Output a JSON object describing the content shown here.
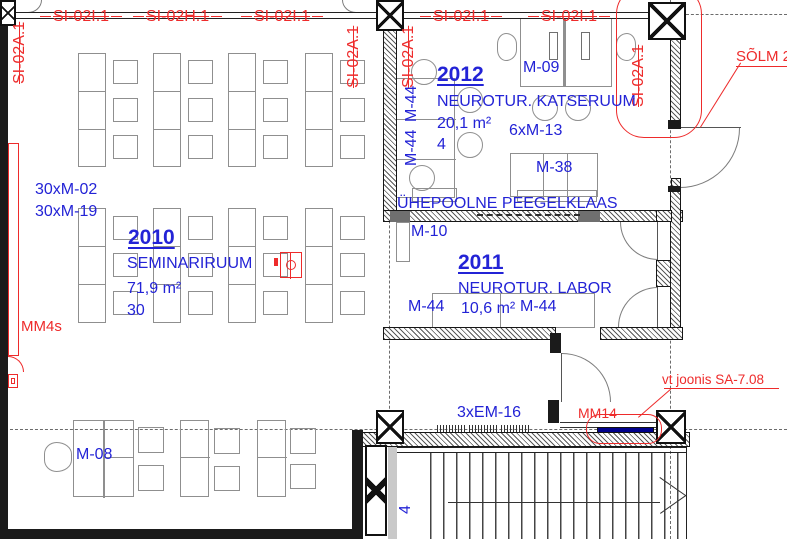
{
  "title": "floor-plan-detail",
  "colors": {
    "text_blue": "#2323d6",
    "annotation_red": "#ee2b2b",
    "wall_black": "#1b1b1b",
    "furniture_gray": "#8f8f8f",
    "mm14_bar_blue": "#00008b"
  },
  "top_grid_labels": [
    "SI-02I.1",
    "SI-02H.1",
    "SI-02I.1",
    "SI-02I.1",
    "SI-02I.1"
  ],
  "vertical_grid_labels": [
    "SI-02A.1",
    "SI-02A.1",
    "SI-02A.1",
    "SI-02A.1"
  ],
  "rooms": {
    "r2010": {
      "number": "2010",
      "name": "SEMINARIRUUM",
      "area": "71,9 m²",
      "seats": "30"
    },
    "r2012": {
      "number": "2012",
      "name": "NEUROTUR. KATSERUUM",
      "area": "20,1 m²",
      "seats": "4"
    },
    "r2011": {
      "number": "2011",
      "name": "NEUROTUR. LABOR",
      "area": "10,6 m²"
    }
  },
  "furniture_labels": {
    "m02": "30xM-02",
    "m19": "30xM-19",
    "m08": "M-08",
    "m44_wall_a": "M-44",
    "m44_wall_b": "M-44",
    "m09": "M-09",
    "m13": "6xM-13",
    "m38": "M-38",
    "m10": "M-10",
    "m44_lab_left": "M-44",
    "m44_lab_right": "M-44",
    "em16": "3xEM-16",
    "label4": "4"
  },
  "red_annotations": {
    "solm": "SÕLM 2",
    "mm4s": "MM4s",
    "mm14": "MM14",
    "vt_joonis": "vt joonis SA-7.08"
  },
  "notes": {
    "mirror_glass": "ÜHEPOOLNE PEEGELKLAAS"
  }
}
